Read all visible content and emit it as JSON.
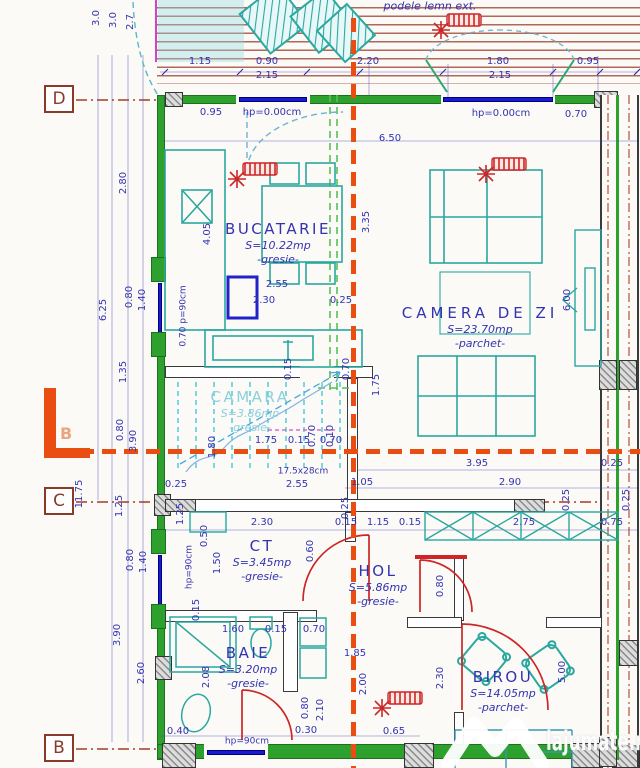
{
  "plan": {
    "rooms": [
      {
        "name": "BUCATARIE",
        "area": "S=10.22mp",
        "finish": "-gresie-",
        "x": 278,
        "y": 228
      },
      {
        "name": "CAMERA DE ZI",
        "area": "S=23.70mp",
        "finish": "-parchet-",
        "x": 480,
        "y": 312,
        "wide": true
      },
      {
        "name": "CAMARA",
        "area": "S=3.86mp",
        "finish": "-gresie-",
        "x": 250,
        "y": 396,
        "pale": true
      },
      {
        "name": "CT",
        "area": "S=3.45mp",
        "finish": "-gresie-",
        "x": 262,
        "y": 545
      },
      {
        "name": "HOL",
        "area": "S=5.86mp",
        "finish": "-gresie-",
        "x": 378,
        "y": 570
      },
      {
        "name": "BAIE",
        "area": "S=3.20mp",
        "finish": "-gresie-",
        "x": 248,
        "y": 652
      },
      {
        "name": "BIROU",
        "area": "S=14.05mp",
        "finish": "-parchet-",
        "x": 503,
        "y": 676
      }
    ],
    "dims": [
      {
        "t": "podele lemn ext.",
        "x": 430,
        "y": 6,
        "i": 1,
        "s": 11
      },
      {
        "t": "1.15",
        "x": 200,
        "y": 62
      },
      {
        "t": "0.90",
        "x": 267,
        "y": 62
      },
      {
        "t": "2.15",
        "x": 267,
        "y": 76
      },
      {
        "t": "2.20",
        "x": 368,
        "y": 62
      },
      {
        "t": "1.80",
        "x": 498,
        "y": 62
      },
      {
        "t": "2.15",
        "x": 500,
        "y": 76
      },
      {
        "t": "0.95",
        "x": 588,
        "y": 62
      },
      {
        "t": "3.0",
        "x": 97,
        "y": 18,
        "r": -90
      },
      {
        "t": "3.0",
        "x": 114,
        "y": 20,
        "r": -90
      },
      {
        "t": "2.7",
        "x": 131,
        "y": 22,
        "r": -90
      },
      {
        "t": "0.95",
        "x": 211,
        "y": 113
      },
      {
        "t": "hp=0.00cm",
        "x": 272,
        "y": 113
      },
      {
        "t": "hp=0.00cm",
        "x": 501,
        "y": 114
      },
      {
        "t": "0.70",
        "x": 576,
        "y": 115
      },
      {
        "t": "6.50",
        "x": 390,
        "y": 139
      },
      {
        "t": "2.80",
        "x": 124,
        "y": 183,
        "r": -90
      },
      {
        "t": "4.05",
        "x": 208,
        "y": 234,
        "r": -90
      },
      {
        "t": "3.35",
        "x": 367,
        "y": 222,
        "r": -90
      },
      {
        "t": "6.25",
        "x": 104,
        "y": 310,
        "r": -90
      },
      {
        "t": "0.80",
        "x": 130,
        "y": 297,
        "r": -90
      },
      {
        "t": "1.40",
        "x": 143,
        "y": 300,
        "r": -90
      },
      {
        "t": "1.35",
        "x": 124,
        "y": 372,
        "r": -90
      },
      {
        "t": "0.70 p=90cm",
        "x": 184,
        "y": 316,
        "r": -90,
        "s": 9
      },
      {
        "t": "2.55",
        "x": 277,
        "y": 285
      },
      {
        "t": "2.30",
        "x": 264,
        "y": 301
      },
      {
        "t": "0.25",
        "x": 341,
        "y": 301
      },
      {
        "t": "1.80",
        "x": 213,
        "y": 447,
        "r": -90
      },
      {
        "t": "0.15",
        "x": 289,
        "y": 369,
        "r": -90
      },
      {
        "t": "0.70",
        "x": 347,
        "y": 369,
        "r": -90
      },
      {
        "t": "0.70",
        "x": 313,
        "y": 436,
        "r": -90
      },
      {
        "t": "0.10",
        "x": 331,
        "y": 436,
        "r": -90
      },
      {
        "t": "1.75",
        "x": 266,
        "y": 441
      },
      {
        "t": "0.15",
        "x": 299,
        "y": 441
      },
      {
        "t": "0.70",
        "x": 331,
        "y": 441
      },
      {
        "t": "1.75",
        "x": 377,
        "y": 385,
        "r": -90
      },
      {
        "t": "17.5x28cm",
        "x": 303,
        "y": 472,
        "s": 9
      },
      {
        "t": "0.25",
        "x": 176,
        "y": 485
      },
      {
        "t": "2.55",
        "x": 297,
        "y": 485
      },
      {
        "t": "0.80",
        "x": 121,
        "y": 430,
        "r": -90
      },
      {
        "t": "3.90",
        "x": 134,
        "y": 441,
        "r": -90
      },
      {
        "t": "11.75",
        "x": 80,
        "y": 494,
        "r": -90
      },
      {
        "t": "3.95",
        "x": 477,
        "y": 464
      },
      {
        "t": "0.25",
        "x": 612,
        "y": 464
      },
      {
        "t": "1.05",
        "x": 362,
        "y": 483
      },
      {
        "t": "2.90",
        "x": 510,
        "y": 483
      },
      {
        "t": "0.25",
        "x": 567,
        "y": 500,
        "r": -90
      },
      {
        "t": "1.25",
        "x": 120,
        "y": 506,
        "r": -90
      },
      {
        "t": "1.25",
        "x": 181,
        "y": 514,
        "r": -90
      },
      {
        "t": "2.30",
        "x": 262,
        "y": 523
      },
      {
        "t": "0.15",
        "x": 346,
        "y": 523
      },
      {
        "t": "1.15",
        "x": 378,
        "y": 523
      },
      {
        "t": "0.15",
        "x": 410,
        "y": 523
      },
      {
        "t": "2.75",
        "x": 524,
        "y": 523
      },
      {
        "t": "0.75",
        "x": 612,
        "y": 523
      },
      {
        "t": "0.25",
        "x": 346,
        "y": 508,
        "r": -90
      },
      {
        "t": "0.60",
        "x": 311,
        "y": 551,
        "r": -90
      },
      {
        "t": "0.50",
        "x": 205,
        "y": 536,
        "r": -90
      },
      {
        "t": "1.50",
        "x": 218,
        "y": 563,
        "r": -90
      },
      {
        "t": "hp=90cm",
        "x": 190,
        "y": 567,
        "r": -90,
        "s": 9
      },
      {
        "t": "0.80",
        "x": 131,
        "y": 560,
        "r": -90
      },
      {
        "t": "1.40",
        "x": 144,
        "y": 562,
        "r": -90
      },
      {
        "t": "3.90",
        "x": 118,
        "y": 635,
        "r": -90
      },
      {
        "t": "2.60",
        "x": 142,
        "y": 673,
        "r": -90
      },
      {
        "t": "0.15",
        "x": 197,
        "y": 610,
        "r": -90
      },
      {
        "t": "1.60",
        "x": 233,
        "y": 630
      },
      {
        "t": "0.15",
        "x": 276,
        "y": 630
      },
      {
        "t": "0.70",
        "x": 314,
        "y": 630
      },
      {
        "t": "1.85",
        "x": 355,
        "y": 654
      },
      {
        "t": "2.00",
        "x": 364,
        "y": 684,
        "r": -90
      },
      {
        "t": "0.80",
        "x": 441,
        "y": 586,
        "r": -90
      },
      {
        "t": "2.08",
        "x": 207,
        "y": 677,
        "r": -90
      },
      {
        "t": "0.80",
        "x": 306,
        "y": 708,
        "r": -90
      },
      {
        "t": "2.10",
        "x": 321,
        "y": 710,
        "r": -90
      },
      {
        "t": "0.40",
        "x": 178,
        "y": 732
      },
      {
        "t": "0.30",
        "x": 306,
        "y": 731
      },
      {
        "t": "0.65",
        "x": 394,
        "y": 732
      },
      {
        "t": "hp=90cm",
        "x": 247,
        "y": 742,
        "s": 9
      },
      {
        "t": "2.30",
        "x": 441,
        "y": 678,
        "r": -90
      },
      {
        "t": "5.00",
        "x": 563,
        "y": 672,
        "r": -90
      },
      {
        "t": "6.00",
        "x": 568,
        "y": 300,
        "r": -90
      },
      {
        "t": "0.25",
        "x": 627,
        "y": 500,
        "r": -90
      }
    ],
    "grid_markers": [
      {
        "label": "D",
        "y": 99
      },
      {
        "label": "C",
        "y": 501
      },
      {
        "label": "B",
        "y": 748
      }
    ],
    "section_label": "B",
    "watermark": "lajumate.ro",
    "colors": {
      "dimension_text": "#3333b2",
      "walls": "#2da02d",
      "furniture": "#2aa8a0",
      "section_line": "#ea4d12",
      "doors": "#cc2626",
      "axis": "#b0523f",
      "window": "#1a1ad0",
      "stairs_dash": "#45c8d8",
      "terrace_stripe": "#b06858",
      "marker_box": "#8a3a28"
    }
  }
}
